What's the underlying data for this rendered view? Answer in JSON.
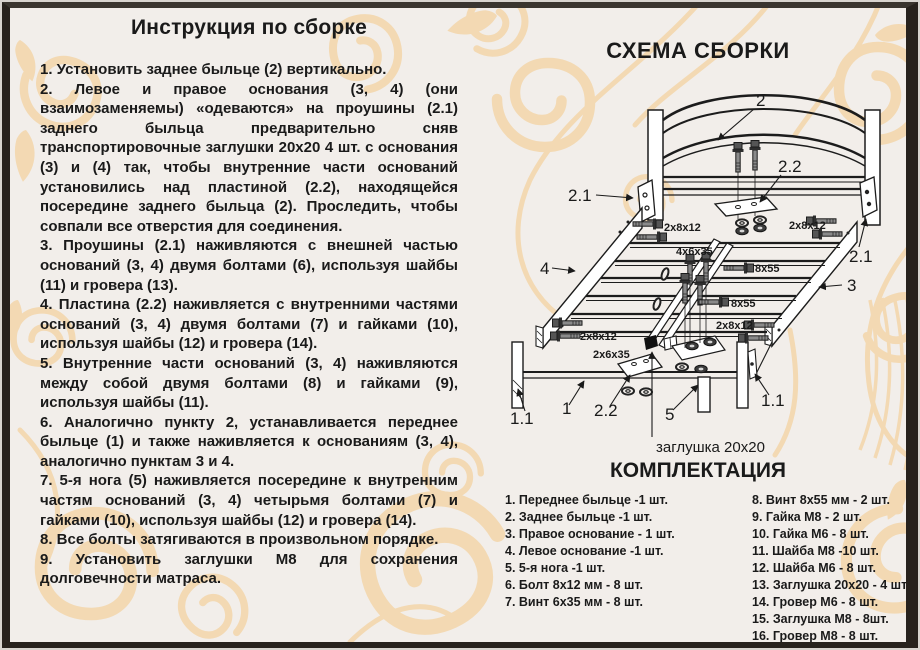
{
  "instructions": {
    "title": "Инструкция по сборке",
    "steps": [
      "1. Установить заднее быльце (2) вертикально.",
      "2. Левое и правое основания (3, 4) (они взаимозаменяемы) «одеваются» на проушины (2.1) заднего быльца предварительно сняв транспортировочные заглушки 20х20 4 шт. с основания (3) и (4) так, чтобы внутренние части оснований установились над пластиной (2.2), находящейся посередине заднего быльца (2). Проследить, чтобы совпали все отверстия для соединения.",
      "3. Проушины (2.1) наживляются с внешней частью оснований (3, 4) двумя болтами (6), используя шайбы (11) и гровера (13).",
      "4. Пластина (2.2) наживляется с внутренними частями оснований (3, 4) двумя болтами (7) и гайками (10), используя шайбы (12) и гровера (14).",
      "5. Внутренние части оснований (3, 4) наживляются между собой двумя болтами (8) и гайками (9), используя шайбы (11).",
      "6. Аналогично пункту 2, устанавливается переднее быльце (1) и также наживляется к основаниям (3, 4), аналогично пунктам 3 и 4.",
      "7. 5-я нога (5) наживляется посередине к внутренним частям оснований (3, 4) четырьмя болтами (7) и гайками (10), используя шайбы (12) и гровера (14).",
      "8. Все болты затягиваются в произвольном порядке.",
      "9. Установить заглушки М8 для сохранения долговечности матраса."
    ]
  },
  "diagram": {
    "title": "СХЕМА СБОРКИ",
    "callouts": {
      "headboard": "2",
      "lug": "2.1",
      "plate": "2.2",
      "left_base": "4",
      "right_base": "3",
      "front": "1",
      "front_leg": "1.1",
      "fifth_leg": "5",
      "plug": "заглушка 20х20"
    },
    "fasteners": {
      "bolt_8x12": "2х8х12",
      "screw_6x35_center": "4х6х35",
      "screw_8x55": "8х55",
      "screw_6x35_pair": "2х6х35"
    }
  },
  "parts": {
    "title": "КОМПЛЕКТАЦИЯ",
    "col1": [
      "1. Переднее быльце -1 шт.",
      "2. Заднее быльце -1 шт.",
      "3. Правое основание - 1 шт.",
      "4. Левое основание -1 шт.",
      "5. 5-я нога -1 шт.",
      "6. Болт 8х12 мм - 8 шт.",
      "7. Винт 6х35 мм - 8 шт."
    ],
    "col2": [
      "8. Винт 8х55 мм - 2 шт.",
      "9. Гайка М8 - 2 шт.",
      "10. Гайка М6 - 8 шт.",
      "11. Шайба М8 -10 шт.",
      "12. Шайба М6 - 8 шт.",
      "13. Заглушка 20х20 - 4 шт.",
      "14. Гровер М6 - 8 шт.",
      "15. Заглушка М8 - 8шт.",
      "16. Гровер М8 - 8 шт."
    ]
  }
}
